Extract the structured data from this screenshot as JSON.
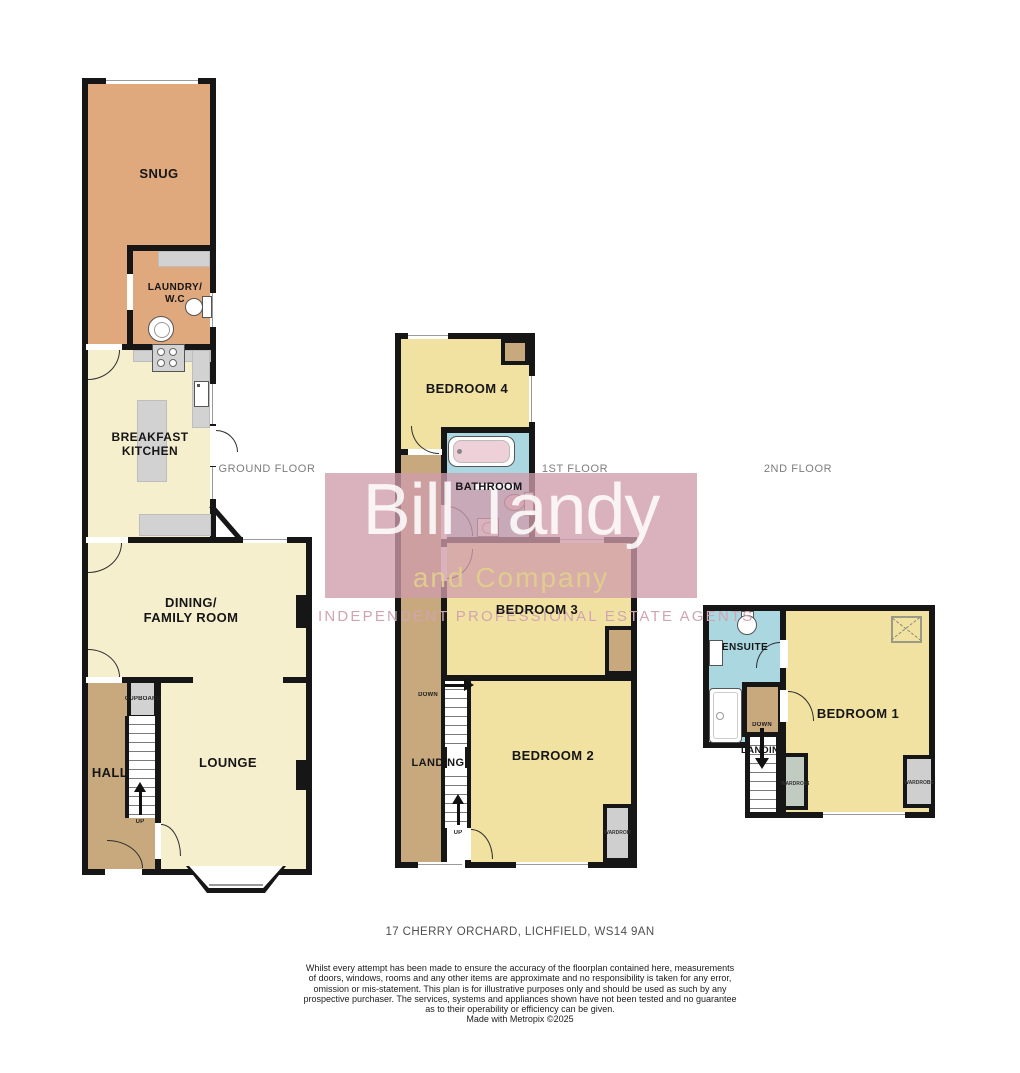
{
  "colors": {
    "wall": "#161616",
    "room_orange": "#dfa87d",
    "room_cream": "#f6efce",
    "room_tan": "#c8a87d",
    "room_yellow": "#f2e2a2",
    "room_blue": "#abd7e1",
    "counter_gray": "#d2d2d2",
    "wardrobe_gray": "#cfcfcf",
    "wardrobe_green": "#c2cbc1",
    "bath_pink": "#eed0d8",
    "brand_pink": "#cf9cab",
    "brand_gold": "#d9c98c",
    "tagline_pink": "#d0a5b1",
    "floor_label_gray": "#7d7d7d"
  },
  "floors": {
    "ground": {
      "label": "GROUND FLOOR",
      "snug": "SNUG",
      "laundry": "LAUNDRY/\nW.C",
      "kitchen": "BREAKFAST\nKITCHEN",
      "dining": "DINING/\nFAMILY ROOM",
      "hall": "HALL",
      "lounge": "LOUNGE",
      "cupboard": "CUPBOARD",
      "up": "UP"
    },
    "first": {
      "label": "1ST FLOOR",
      "bedroom4": "BEDROOM 4",
      "bathroom": "BATHROOM",
      "bedroom3": "BEDROOM 3",
      "bedroom2": "BEDROOM 2",
      "landing": "LANDING",
      "down": "DOWN",
      "up": "UP",
      "wardrobe": "WARDROBE"
    },
    "second": {
      "label": "2ND FLOOR",
      "ensuite": "ENSUITE",
      "bedroom1": "BEDROOM 1",
      "landing": "LANDING",
      "down": "DOWN",
      "wardrobe_left": "WARDROBE",
      "wardrobe_right": "WARDROBE"
    }
  },
  "watermark": {
    "name_line": "Bill Tandy",
    "sub_line": "and Company",
    "tagline": "INDEPENDENT PROFESSIONAL ESTATE AGENTS"
  },
  "footer": {
    "address": "17 CHERRY ORCHARD, LICHFIELD, WS14 9AN",
    "disclaimer_lines": [
      "Whilst every attempt has been made to ensure the accuracy of the floorplan contained here, measurements",
      "of doors, windows, rooms and any other items are approximate and no responsibility is taken for any error,",
      "omission or mis-statement. This plan is for illustrative purposes only and should be used as such by any",
      "prospective purchaser. The services, systems and appliances shown have not been tested and no guarantee",
      "as to their operability or efficiency can be given.",
      "Made with Metropix ©2025"
    ]
  }
}
